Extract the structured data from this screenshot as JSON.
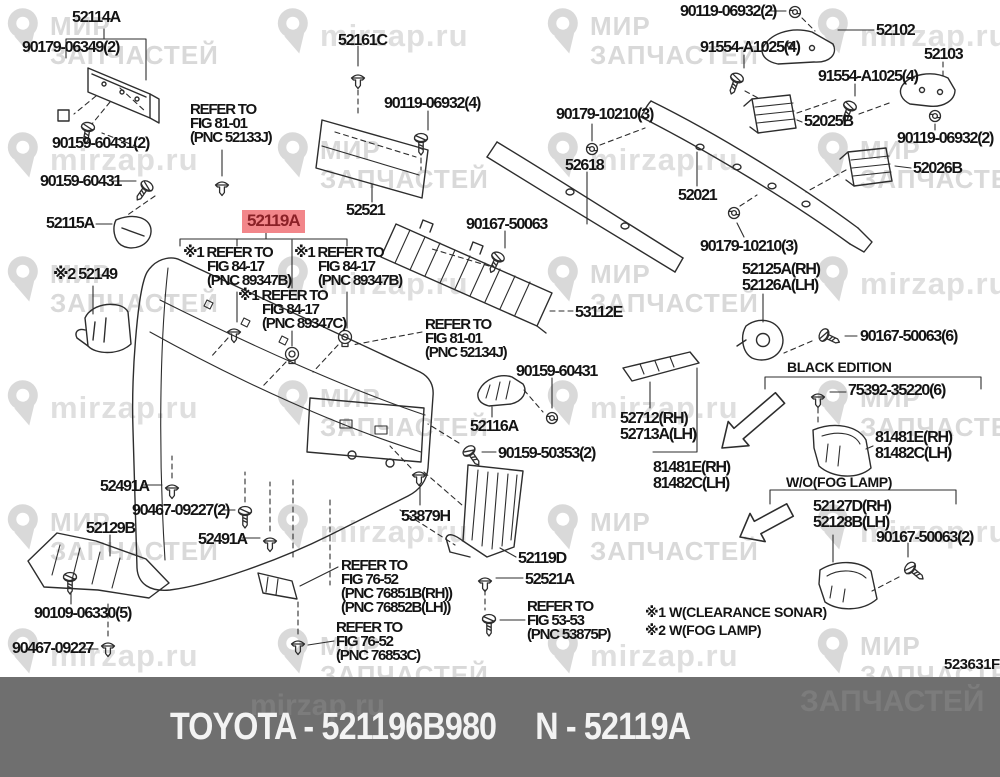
{
  "highlight": {
    "text": "52119A",
    "bg": "#f2868a",
    "fg": "#8b2127"
  },
  "banner": {
    "left_text": "TOYOTA - 521196B980",
    "right_text": "N - 52119A",
    "bg": "#6f6f6f",
    "fg": "#f3f3f3"
  },
  "diagram_code": "523631F",
  "watermark": {
    "brand_line1": "МИР",
    "brand_line2": "ЗАПЧАСТЕЙ",
    "url": "mirzap.ru",
    "color": "#d9d9d9"
  },
  "colors": {
    "line_art": "#2d2d2d",
    "label_text": "#141414"
  },
  "labels": [
    {
      "id": "52114A",
      "x": 72,
      "y": 10,
      "lines": [
        "52114A"
      ]
    },
    {
      "id": "90179-06349-2",
      "x": 22,
      "y": 40,
      "lines": [
        "90179-06349(2)"
      ]
    },
    {
      "id": "90159-60431-2",
      "x": 52,
      "y": 136,
      "lines": [
        "90159-60431(2)"
      ]
    },
    {
      "id": "90159-60431-a",
      "x": 40,
      "y": 174,
      "lines": [
        "90159-60431"
      ]
    },
    {
      "id": "52115A",
      "x": 46,
      "y": 216,
      "lines": [
        "52115A"
      ]
    },
    {
      "id": "refer-52133J",
      "x": 190,
      "y": 103,
      "cls": "ref",
      "lines": [
        "REFER TO",
        "FIG 81-01",
        "(PNC 52133J)"
      ]
    },
    {
      "id": "52161C",
      "x": 338,
      "y": 33,
      "lines": [
        "52161C"
      ]
    },
    {
      "id": "90119-06932-4",
      "x": 384,
      "y": 96,
      "lines": [
        "90119-06932(4)"
      ]
    },
    {
      "id": "52521",
      "x": 346,
      "y": 203,
      "lines": [
        "52521"
      ]
    },
    {
      "id": "90119-06932-2a",
      "x": 680,
      "y": 4,
      "lines": [
        "90119-06932(2)"
      ]
    },
    {
      "id": "52102",
      "x": 876,
      "y": 23,
      "lines": [
        "52102"
      ]
    },
    {
      "id": "91554-A1025-4a",
      "x": 700,
      "y": 40,
      "lines": [
        "91554-A1025(4)"
      ]
    },
    {
      "id": "52103",
      "x": 924,
      "y": 47,
      "lines": [
        "52103"
      ]
    },
    {
      "id": "91554-A1025-4b",
      "x": 818,
      "y": 69,
      "lines": [
        "91554-A1025(4)"
      ]
    },
    {
      "id": "52025B",
      "x": 804,
      "y": 114,
      "lines": [
        "52025B"
      ]
    },
    {
      "id": "90119-06932-2b",
      "x": 897,
      "y": 131,
      "lines": [
        "90119-06932(2)"
      ]
    },
    {
      "id": "52026B",
      "x": 913,
      "y": 161,
      "lines": [
        "52026B"
      ]
    },
    {
      "id": "90179-10210-3a",
      "x": 556,
      "y": 107,
      "lines": [
        "90179-10210(3)"
      ]
    },
    {
      "id": "52618",
      "x": 565,
      "y": 158,
      "lines": [
        "52618"
      ]
    },
    {
      "id": "52021",
      "x": 678,
      "y": 188,
      "lines": [
        "52021"
      ]
    },
    {
      "id": "90167-50063-a",
      "x": 466,
      "y": 217,
      "lines": [
        "90167-50063"
      ]
    },
    {
      "id": "90179-10210-3b",
      "x": 700,
      "y": 239,
      "lines": [
        "90179-10210(3)"
      ]
    },
    {
      "id": "53112E",
      "x": 575,
      "y": 305,
      "lines": [
        "53112E"
      ]
    },
    {
      "id": "52149",
      "x": 53,
      "y": 267,
      "lines": [
        "※2 52149"
      ]
    },
    {
      "id": "refer-89347B-left",
      "x": 183,
      "y": 246,
      "cls": "ref",
      "indent": true,
      "lines": [
        "※1 REFER TO",
        "FIG 84-17",
        "(PNC 89347B)"
      ]
    },
    {
      "id": "refer-89347B-right",
      "x": 294,
      "y": 246,
      "cls": "ref",
      "indent": true,
      "lines": [
        "※1 REFER TO",
        "FIG 84-17",
        "(PNC 89347B)"
      ]
    },
    {
      "id": "refer-89347C",
      "x": 238,
      "y": 289,
      "cls": "ref",
      "indent": true,
      "lines": [
        "※1 REFER TO",
        "FIG 84-17",
        "(PNC 89347C)"
      ]
    },
    {
      "id": "refer-52134J",
      "x": 425,
      "y": 318,
      "cls": "ref",
      "lines": [
        "REFER TO",
        "FIG 81-01",
        "(PNC 52134J)"
      ]
    },
    {
      "id": "90159-60431-b",
      "x": 516,
      "y": 364,
      "lines": [
        "90159-60431"
      ]
    },
    {
      "id": "52116A",
      "x": 470,
      "y": 419,
      "lines": [
        "52116A"
      ]
    },
    {
      "id": "90159-50353-2",
      "x": 498,
      "y": 446,
      "lines": [
        "90159-50353(2)"
      ]
    },
    {
      "id": "52125A-52126A",
      "x": 742,
      "y": 262,
      "lines": [
        "52125A(RH)",
        "52126A(LH)"
      ]
    },
    {
      "id": "90167-50063-6",
      "x": 860,
      "y": 329,
      "lines": [
        "90167-50063(6)"
      ]
    },
    {
      "id": "black-edition",
      "x": 787,
      "y": 360,
      "cls": "sans",
      "lines": [
        "BLACK EDITION"
      ]
    },
    {
      "id": "75392-35220-6",
      "x": 848,
      "y": 383,
      "lines": [
        "75392-35220(6)"
      ]
    },
    {
      "id": "81481E-right",
      "x": 875,
      "y": 430,
      "lines": [
        "81481E(RH)",
        "81482C(LH)"
      ]
    },
    {
      "id": "52712-52713A",
      "x": 620,
      "y": 411,
      "lines": [
        "52712(RH)",
        "52713A(LH)"
      ]
    },
    {
      "id": "81481E-center",
      "x": 653,
      "y": 460,
      "lines": [
        "81481E(RH)",
        "81482C(LH)"
      ]
    },
    {
      "id": "wo-fog-lamp",
      "x": 786,
      "y": 475,
      "cls": "sans",
      "lines": [
        "W/O(FOG LAMP)"
      ]
    },
    {
      "id": "52127D-52128B",
      "x": 813,
      "y": 499,
      "lines": [
        "52127D(RH)",
        "52128B(LH)"
      ]
    },
    {
      "id": "90167-50063-2",
      "x": 876,
      "y": 530,
      "lines": [
        "90167-50063(2)"
      ]
    },
    {
      "id": "52119D",
      "x": 518,
      "y": 551,
      "lines": [
        "52119D"
      ]
    },
    {
      "id": "52521A",
      "x": 525,
      "y": 572,
      "lines": [
        "52521A"
      ]
    },
    {
      "id": "refer-53875P",
      "x": 527,
      "y": 600,
      "cls": "ref",
      "lines": [
        "REFER TO",
        "FIG 53-53",
        "(PNC 53875P)"
      ]
    },
    {
      "id": "note-clearance-sonar",
      "x": 645,
      "y": 605,
      "cls": "sans",
      "lines": [
        "※1 W(CLEARANCE SONAR)"
      ]
    },
    {
      "id": "note-fog-lamp",
      "x": 645,
      "y": 623,
      "cls": "sans",
      "lines": [
        "※2 W(FOG LAMP)"
      ]
    },
    {
      "id": "53879H",
      "x": 401,
      "y": 509,
      "lines": [
        "53879H"
      ]
    },
    {
      "id": "refer-76851B",
      "x": 341,
      "y": 559,
      "cls": "ref",
      "lines": [
        "REFER TO",
        "FIG 76-52",
        "(PNC 76851B(RH))",
        "(PNC 76852B(LH))"
      ]
    },
    {
      "id": "refer-76853C",
      "x": 336,
      "y": 621,
      "cls": "ref",
      "lines": [
        "REFER TO",
        "FIG 76-52",
        "(PNC 76853C)"
      ]
    },
    {
      "id": "52129B",
      "x": 86,
      "y": 521,
      "lines": [
        "52129B"
      ]
    },
    {
      "id": "90467-09227-2",
      "x": 132,
      "y": 503,
      "lines": [
        "90467-09227(2)"
      ]
    },
    {
      "id": "52491A-a",
      "x": 100,
      "y": 479,
      "lines": [
        "52491A"
      ]
    },
    {
      "id": "52491A-b",
      "x": 198,
      "y": 532,
      "lines": [
        "52491A"
      ]
    },
    {
      "id": "90109-06330-5",
      "x": 34,
      "y": 606,
      "lines": [
        "90109-06330(5)"
      ]
    },
    {
      "id": "90467-09227",
      "x": 12,
      "y": 641,
      "lines": [
        "90467-09227"
      ]
    }
  ]
}
